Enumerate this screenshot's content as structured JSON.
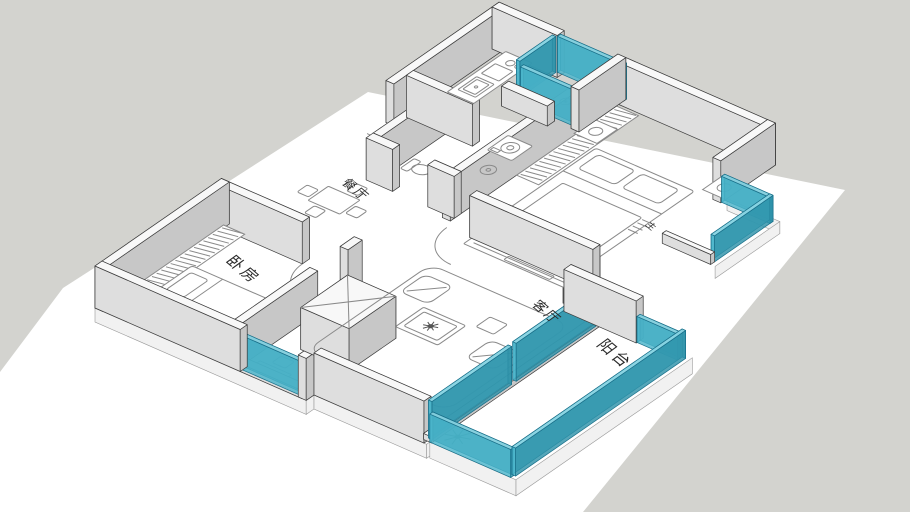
{
  "room_labels": {
    "dining": "餐厅",
    "bedroom": "卧房",
    "living_room": "客厅",
    "balcony": "阳台",
    "master_bedroom": "主"
  },
  "palette": {
    "background": "#d3d3cf",
    "ground": "#ffffff",
    "wall_top": "#f8f8f8",
    "wall_nw": "#ececec",
    "wall_sw": "#dedede",
    "wall_se": "#c7c7c7",
    "wall_ne": "#a5a5a5",
    "glass": "#4ab5cb",
    "glass_light": "#92d9e6",
    "glass_dark": "#2e93aa",
    "outline": "#3d3d3d",
    "furniture_line": "#8a8a8a",
    "plant": "#3f5d42",
    "label_text": "#2b2b2b"
  }
}
